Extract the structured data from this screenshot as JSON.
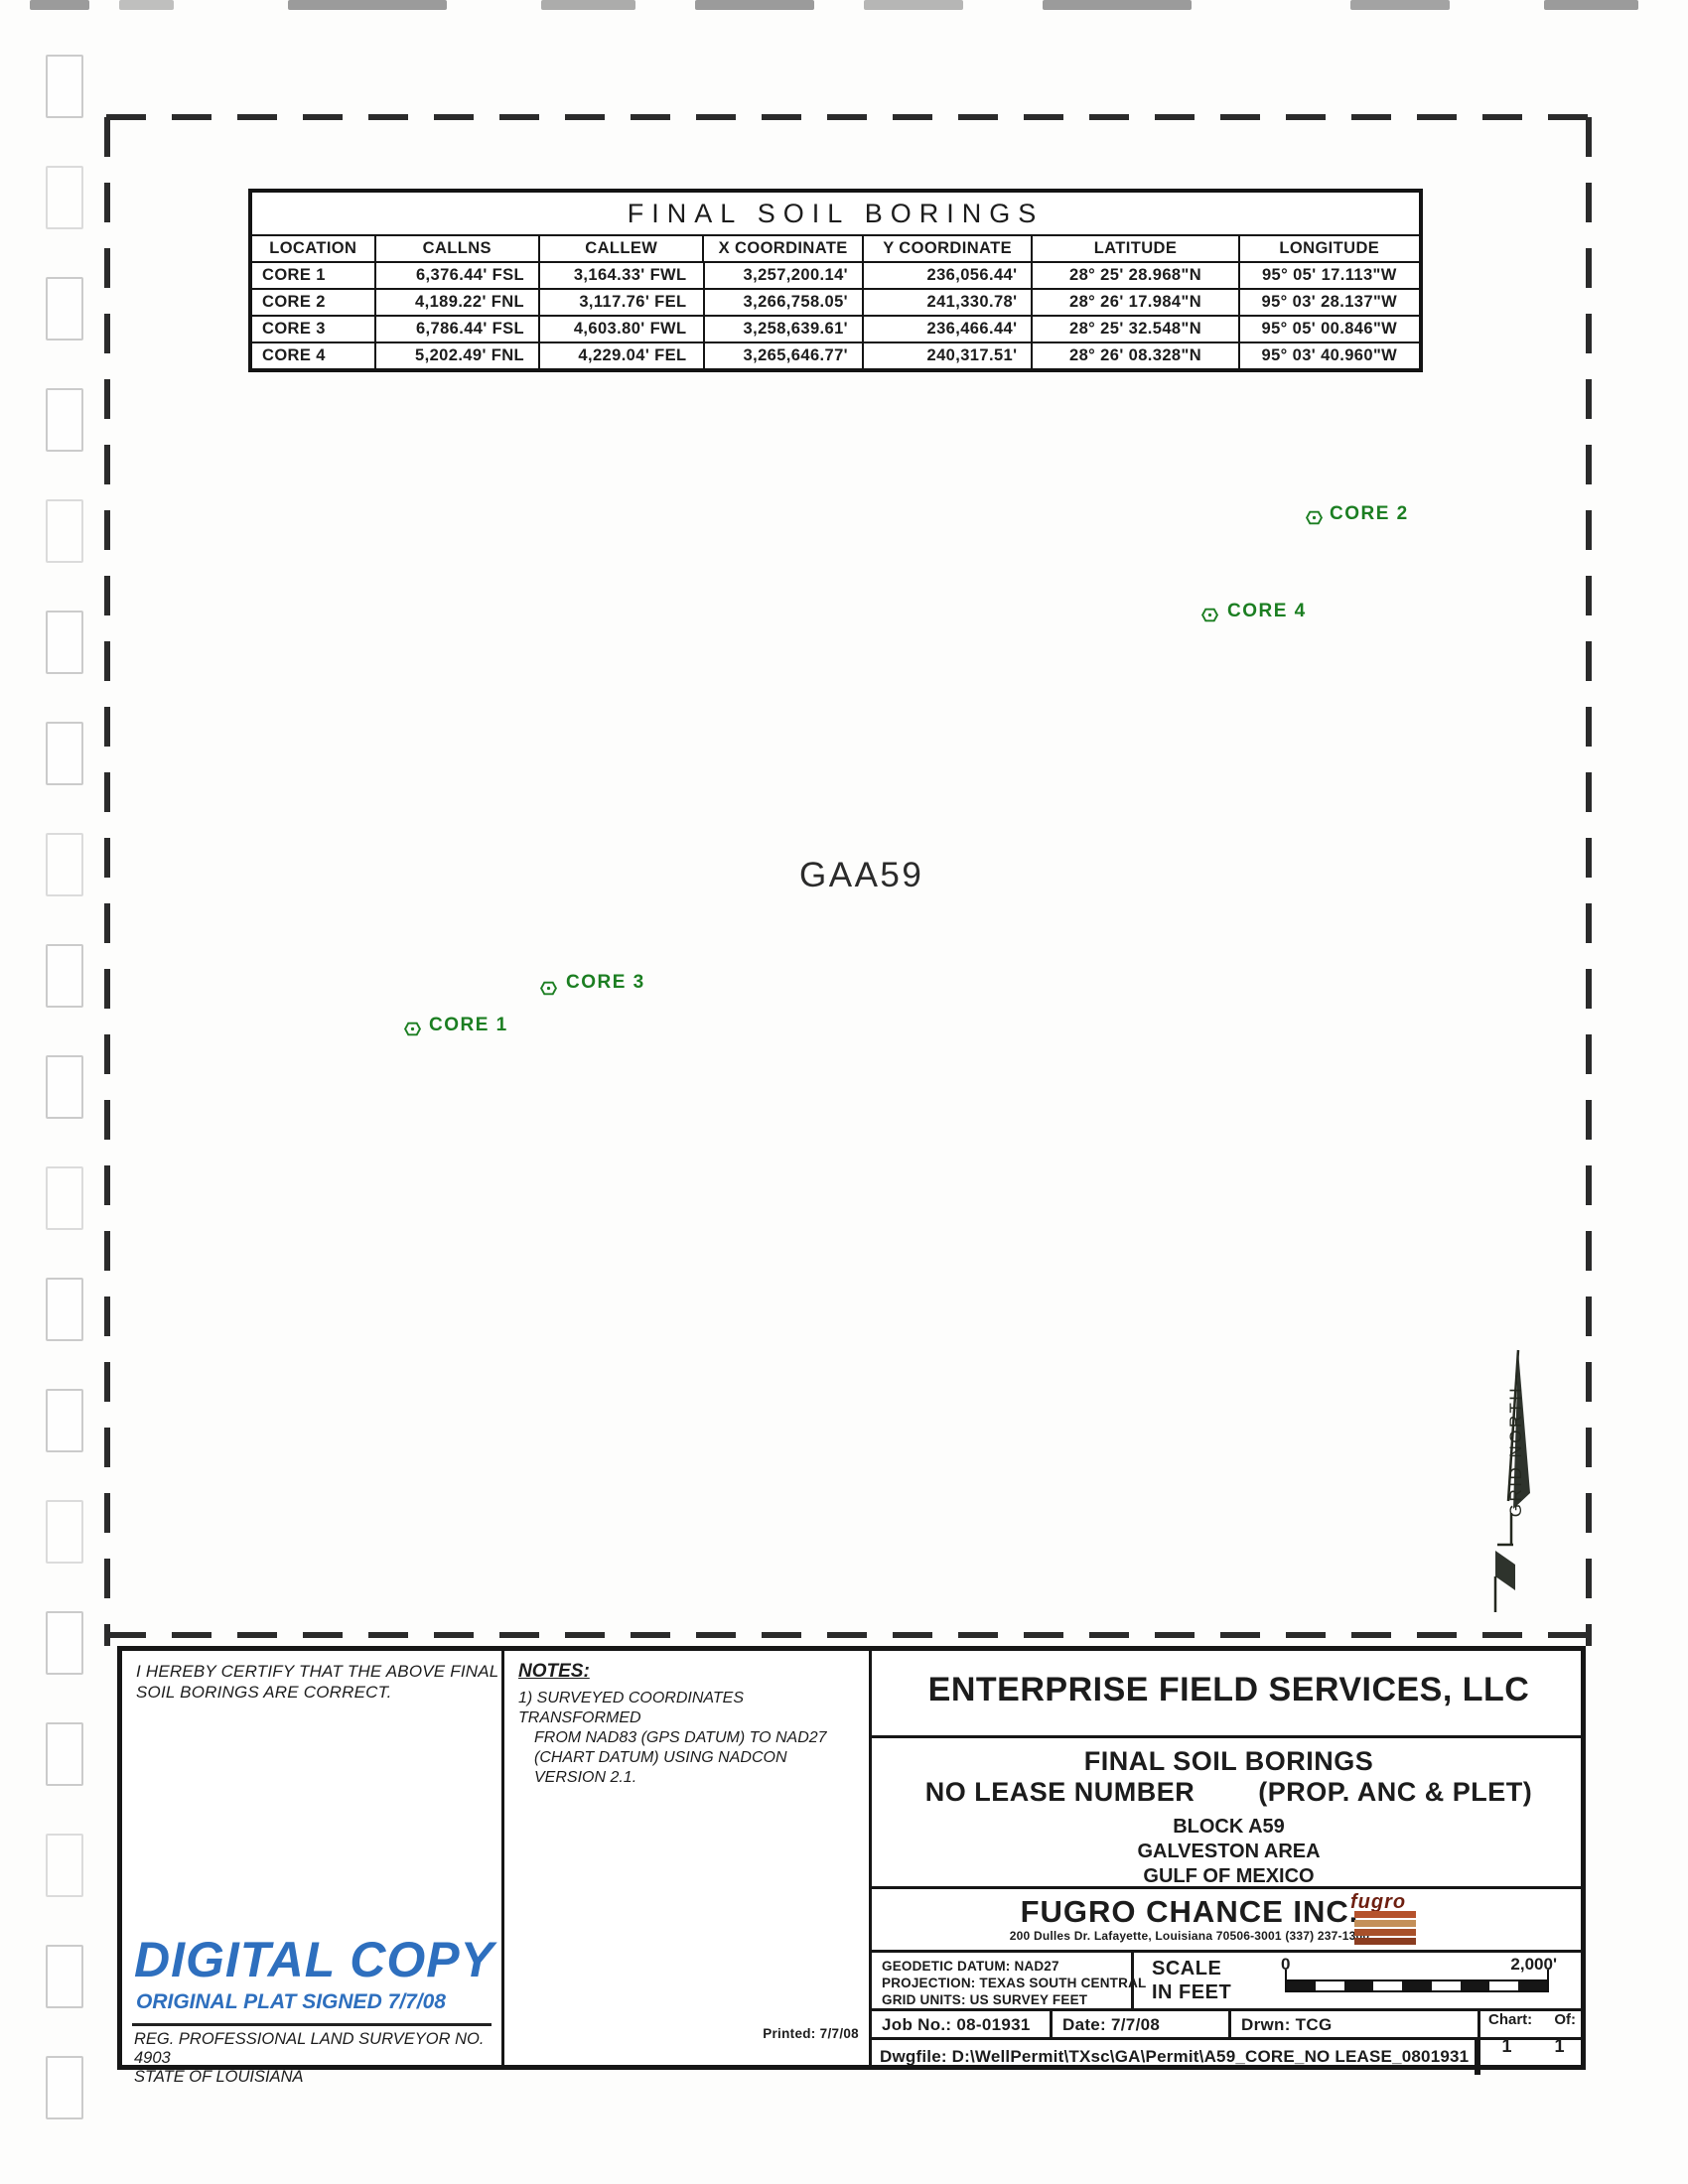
{
  "colors": {
    "marker_green": "#1b7e21",
    "digital_blue": "#2e6fbe",
    "logo_red": "#6e1f10",
    "logo_stripes": [
      "#b5522c",
      "#c49059",
      "#a8502a",
      "#8a3c20"
    ]
  },
  "table": {
    "title": "FINAL SOIL BORINGS",
    "headers": [
      "LOCATION",
      "CALLNS",
      "CALLEW",
      "X COORDINATE",
      "Y COORDINATE",
      "LATITUDE",
      "LONGITUDE"
    ],
    "rows": [
      [
        "CORE 1",
        "6,376.44' FSL",
        "3,164.33' FWL",
        "3,257,200.14'",
        "236,056.44'",
        "28° 25' 28.968\"N",
        "95° 05' 17.113\"W"
      ],
      [
        "CORE 2",
        "4,189.22' FNL",
        "3,117.76' FEL",
        "3,266,758.05'",
        "241,330.78'",
        "28° 26' 17.984\"N",
        "95° 03' 28.137\"W"
      ],
      [
        "CORE 3",
        "6,786.44' FSL",
        "4,603.80' FWL",
        "3,258,639.61'",
        "236,466.44'",
        "28° 25' 32.548\"N",
        "95° 05' 00.846\"W"
      ],
      [
        "CORE 4",
        "5,202.49' FNL",
        "4,229.04' FEL",
        "3,265,646.77'",
        "240,317.51'",
        "28° 26' 08.328\"N",
        "95° 03' 40.960\"W"
      ]
    ]
  },
  "map": {
    "block_label": "GAA59",
    "cores": [
      {
        "label": "CORE 2"
      },
      {
        "label": "CORE 4"
      },
      {
        "label": "CORE 3"
      },
      {
        "label": "CORE 1"
      }
    ],
    "north_label": "GRID NORTH"
  },
  "certification": {
    "line1": "I HEREBY CERTIFY THAT THE ABOVE FINAL",
    "line2": "SOIL BORINGS ARE CORRECT."
  },
  "notes": {
    "heading": "NOTES:",
    "line1": "1) SURVEYED COORDINATES TRANSFORMED",
    "line2": "FROM NAD83 (GPS DATUM) TO NAD27",
    "line3": "(CHART DATUM) USING NADCON",
    "line4": "VERSION 2.1."
  },
  "digital_copy": {
    "title": "DIGITAL COPY",
    "subtitle": "ORIGINAL PLAT SIGNED 7/7/08"
  },
  "surveyor": {
    "line1": "REG. PROFESSIONAL LAND SURVEYOR NO. 4903",
    "line2": "STATE OF LOUISIANA"
  },
  "title_block": {
    "company": "ENTERPRISE FIELD SERVICES, LLC",
    "subject_line1": "FINAL SOIL BORINGS",
    "subject_line2_left": "NO LEASE NUMBER",
    "subject_line2_right": "(PROP. ANC & PLET)",
    "block": "BLOCK A59",
    "area": "GALVESTON AREA",
    "region": "GULF OF MEXICO",
    "firm": "FUGRO CHANCE INC.",
    "firm_address": "200 Dulles Dr.   Lafayette, Louisiana 70506-3001   (337) 237-1300",
    "logo_text": "fugro",
    "geodetic_datum": "GEODETIC DATUM: NAD27",
    "projection": "PROJECTION: TEXAS SOUTH CENTRAL",
    "grid_units": "GRID UNITS: US SURVEY FEET",
    "scale_label1": "SCALE",
    "scale_label2": "IN FEET",
    "scale_zero": "0",
    "scale_max": "2,000'",
    "job_no": "Job No.: 08-01931",
    "date": "Date: 7/7/08",
    "drwn": "Drwn: TCG",
    "chart_label": "Chart:",
    "of_label": "Of:",
    "chart_no": "1",
    "of_no": "1",
    "dwgfile": "Dwgfile: D:\\WellPermit\\TXsc\\GA\\Permit\\A59_CORE_NO LEASE_0801931",
    "printed": "Printed: 7/7/08"
  }
}
